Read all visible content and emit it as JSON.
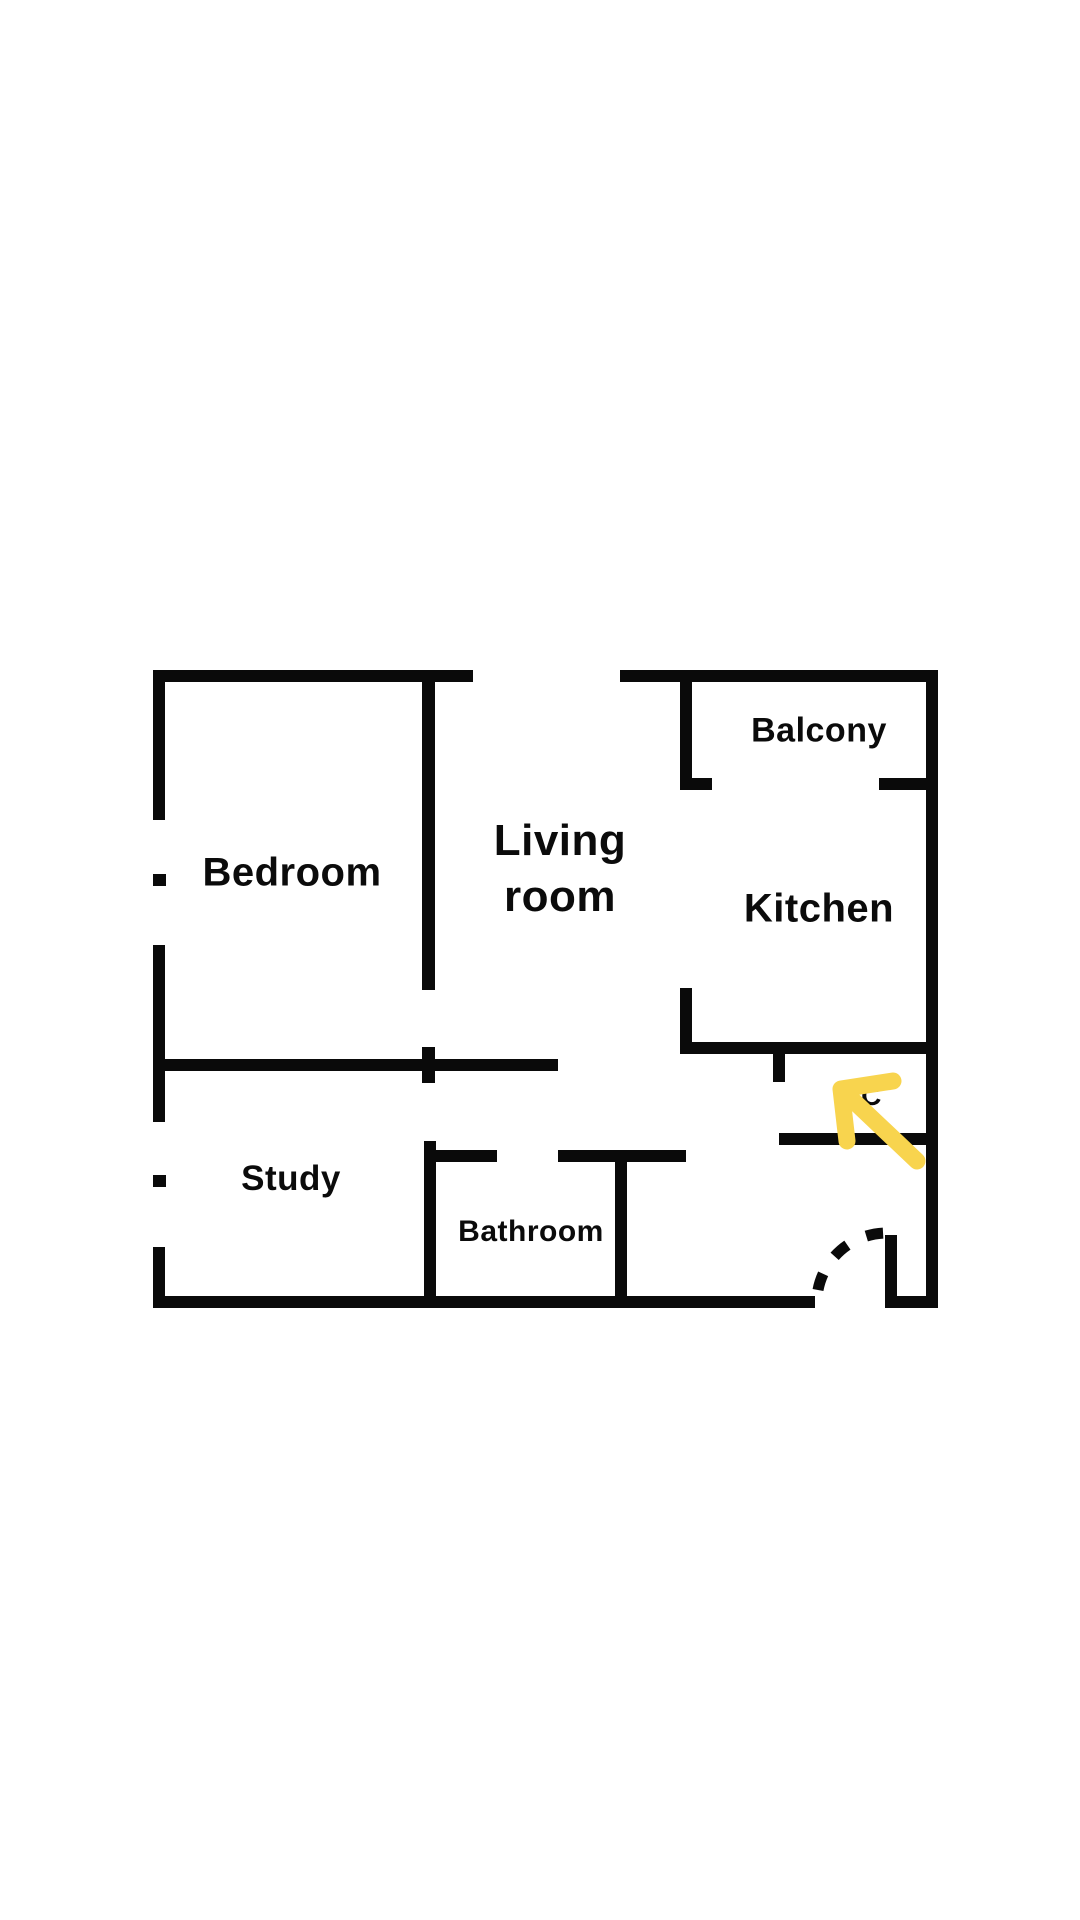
{
  "page": {
    "background_color": "#ffffff"
  },
  "floorplan": {
    "wall_color": "#0a0a0a",
    "rooms": {
      "bedroom": {
        "label": "Bedroom"
      },
      "living": {
        "line1": "Living",
        "line2": "room"
      },
      "balcony": {
        "label": "Balcony"
      },
      "kitchen": {
        "label": "Kitchen"
      },
      "study": {
        "label": "Study"
      },
      "bathroom": {
        "label": "Bathroom"
      },
      "wc": {
        "label": "WC"
      }
    }
  },
  "annotation": {
    "arrow_icon": "arrow-up-left-icon",
    "arrow_color": "#F8D44E"
  }
}
